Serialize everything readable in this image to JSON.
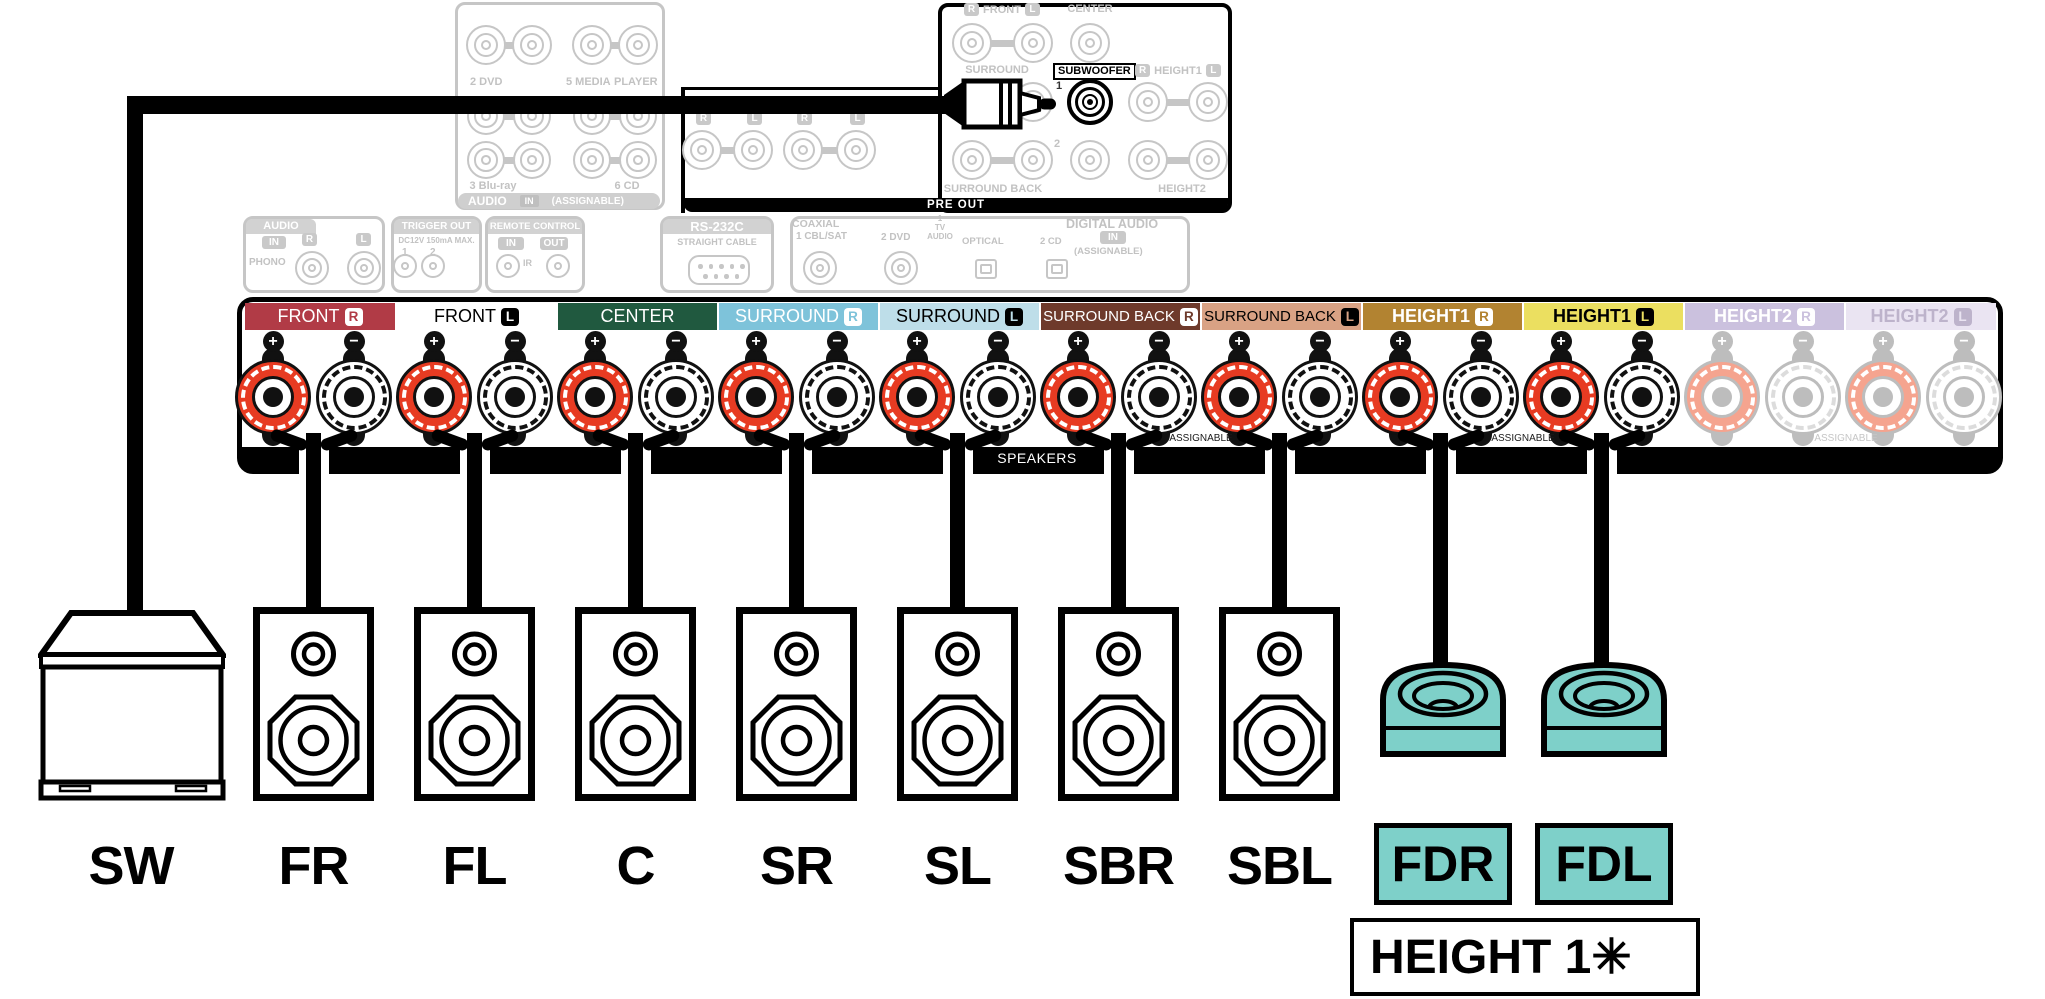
{
  "av_inputs": {
    "cbl_sat_r": "R",
    "cbl_sat": "1 CBL/SAT",
    "cbl_sat_l": "L",
    "game_r": "R",
    "game": "4 GAME",
    "game_l": "L",
    "dvd": "2 DVD",
    "media": "5 MEDIA",
    "player": "PLAYER",
    "bluray": "3 Blu-ray",
    "cd": "6 CD",
    "audio": "AUDIO",
    "in": "IN",
    "assignable": "(ASSIGNABLE)"
  },
  "io": {
    "audio": "AUDIO",
    "audio_in": "IN",
    "r": "R",
    "l": "L",
    "phono": "PHONO",
    "trigger_out": "TRIGGER OUT",
    "trigger_spec": "DC12V 150mA MAX.",
    "trigger_1": "1",
    "trigger_2": "2",
    "remote_control": "REMOTE CONTROL",
    "remote_in": "IN",
    "remote_out": "OUT",
    "ir": "IR",
    "rs232c": "RS-232C",
    "straight_cable": "STRAIGHT CABLE",
    "coaxial": "COAXIAL",
    "coax_cbl_sat": "1 CBL/SAT",
    "coax_dvd": "2 DVD",
    "tv_num": "1",
    "tv": "TV",
    "tv_audio": "AUDIO",
    "optical": "OPTICAL",
    "optical_cd": "2 CD",
    "digital_audio": "DIGITAL AUDIO",
    "digital_in": "IN",
    "digital_assignable": "(ASSIGNABLE)"
  },
  "pre_out": {
    "bar_label": "PRE OUT",
    "front_r": "R",
    "front": "FRONT",
    "front_l": "L",
    "center": "CENTER",
    "surround": "SURROUND",
    "subwoofer": "SUBWOOFER",
    "sub_1": "1",
    "sub_2": "2",
    "height1_r": "R",
    "height1": "HEIGHT1",
    "height1_l": "L",
    "surround_back": "SURROUND BACK",
    "height2": "HEIGHT2",
    "lower": [
      "R",
      "L",
      "R",
      "L"
    ]
  },
  "strip": {
    "speakers_label": "SPEAKERS",
    "assignable_label": "ASSIGNABLE",
    "plus": "+",
    "minus": "−",
    "sections": [
      {
        "label": "FRONT",
        "badge": "R",
        "bg": "#b13b46",
        "fg": "#ffffff",
        "bold": false,
        "faded": false,
        "cable": true
      },
      {
        "label": "FRONT",
        "badge": "L",
        "bg": "#ffffff",
        "fg": "#000000",
        "bold": false,
        "faded": false,
        "cable": true
      },
      {
        "label": "CENTER",
        "badge": "",
        "bg": "#20593f",
        "fg": "#ffffff",
        "bold": false,
        "faded": false,
        "cable": true
      },
      {
        "label": "SURROUND",
        "badge": "R",
        "bg": "#7ec3da",
        "fg": "#ffffff",
        "bold": false,
        "faded": false,
        "cable": true
      },
      {
        "label": "SURROUND",
        "badge": "L",
        "bg": "#bedee9",
        "fg": "#000000",
        "bold": false,
        "faded": false,
        "cable": true
      },
      {
        "label": "SURROUND BACK",
        "badge": "R",
        "bg": "#6e3a2b",
        "fg": "#ffffff",
        "bold": false,
        "faded": false,
        "cable": true
      },
      {
        "label": "SURROUND BACK",
        "badge": "L",
        "bg": "#d9a284",
        "fg": "#000000",
        "bold": false,
        "faded": false,
        "cable": true
      },
      {
        "label": "HEIGHT1",
        "badge": "R",
        "bg": "#b28331",
        "fg": "#ffffff",
        "bold": true,
        "faded": false,
        "cable": true
      },
      {
        "label": "HEIGHT1",
        "badge": "L",
        "bg": "#ebdf60",
        "fg": "#000000",
        "bold": true,
        "faded": false,
        "cable": true
      },
      {
        "label": "HEIGHT2",
        "badge": "R",
        "bg": "#cbc1de",
        "fg": "#ffffff",
        "bold": true,
        "faded": true,
        "cable": false
      },
      {
        "label": "HEIGHT2",
        "badge": "L",
        "bg": "#eae4f2",
        "fg": "#bdb3cb",
        "bold": true,
        "faded": true,
        "cable": false
      }
    ]
  },
  "speaker_row": {
    "items": [
      {
        "label": "SW",
        "kind": "subwoofer"
      },
      {
        "label": "FR",
        "kind": "bookshelf"
      },
      {
        "label": "FL",
        "kind": "bookshelf"
      },
      {
        "label": "C",
        "kind": "bookshelf"
      },
      {
        "label": "SR",
        "kind": "bookshelf"
      },
      {
        "label": "SL",
        "kind": "bookshelf"
      },
      {
        "label": "SBR",
        "kind": "bookshelf"
      },
      {
        "label": "SBL",
        "kind": "bookshelf"
      },
      {
        "label": "FDR",
        "kind": "dolby"
      },
      {
        "label": "FDL",
        "kind": "dolby"
      }
    ]
  },
  "callouts": {
    "height1_note": "HEIGHT 1✳"
  },
  "colors": {
    "post_positive": "#e73b22",
    "post_negative": "#ffffff",
    "dolby_teal": "#7ed0c9",
    "faded_line": "#c6c6c6",
    "black": "#000000"
  }
}
